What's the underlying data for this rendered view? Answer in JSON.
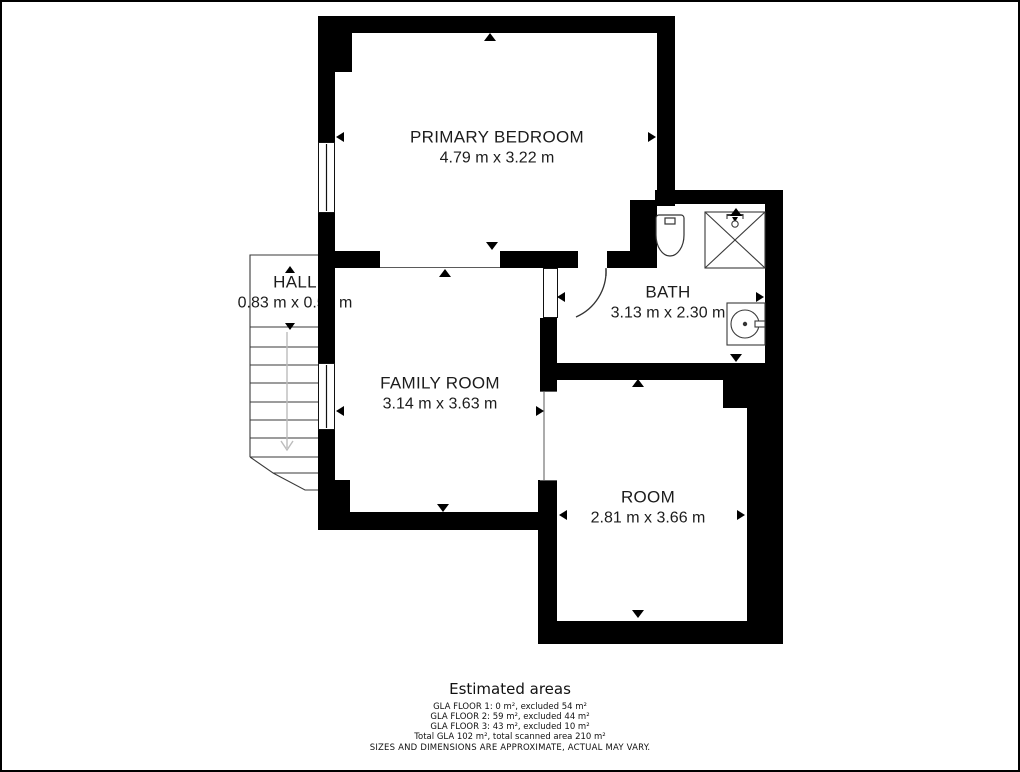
{
  "rooms": [
    {
      "id": "primary-bedroom",
      "name": "PRIMARY BEDROOM",
      "dimensions": "4.79 m x 3.22 m"
    },
    {
      "id": "hall",
      "name": "HALL",
      "dimensions": "0.83 m x 0.55 m"
    },
    {
      "id": "family-room",
      "name": "FAMILY ROOM",
      "dimensions": "3.14 m x 3.63 m"
    },
    {
      "id": "bath",
      "name": "BATH",
      "dimensions": "3.13 m x 2.30 m"
    },
    {
      "id": "room",
      "name": "ROOM",
      "dimensions": "2.81 m x 3.66 m"
    }
  ],
  "estimated_areas": {
    "title": "Estimated areas",
    "lines": [
      "GLA FLOOR 1: 0 m², excluded 54 m²",
      "GLA FLOOR 2: 59 m², excluded 44 m²",
      "GLA FLOOR 3: 43 m², excluded 10 m²",
      "Total GLA 102 m², total scanned area 210 m²"
    ]
  },
  "disclaimer": "SIZES AND DIMENSIONS ARE APPROXIMATE, ACTUAL MAY VARY.",
  "colors": {
    "wall": "#000000",
    "line": "#333333",
    "stair_arrow": "#bcbcbc",
    "text": "#1c1c1c"
  }
}
